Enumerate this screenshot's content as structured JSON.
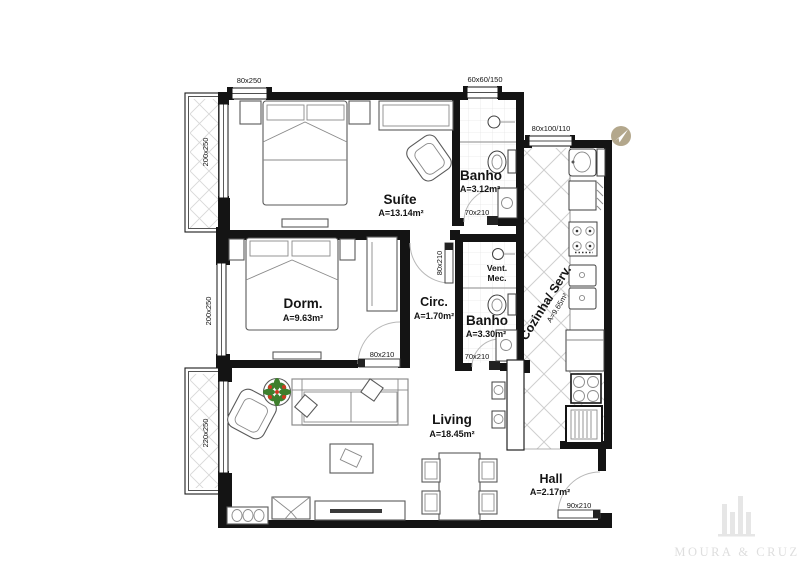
{
  "colors": {
    "background": "#ffffff",
    "walls": "#141414",
    "kitchen_hatch": "#cfcfcf",
    "balcony_hatch": "#d8d8d8",
    "bath_tile": "#e6e6e6",
    "north_icon": "#b3a78c",
    "plant_green": "#3e7f2d",
    "plant_red": "#cc3b22",
    "watermark": "#dedede"
  },
  "rooms": {
    "suite": {
      "name": "Suíte",
      "area": "A=13.14m²"
    },
    "dorm": {
      "name": "Dorm.",
      "area": "A=9.63m²"
    },
    "circ": {
      "name": "Circ.",
      "area": "A=1.70m²"
    },
    "banho_suite": {
      "name": "Banho",
      "area": "A=3.12m²"
    },
    "banho_social": {
      "name": "Banho",
      "area": "A=3.30m²"
    },
    "cozinha": {
      "name": "Cozinha/ Serv.",
      "area": "A=9.65m²"
    },
    "living": {
      "name": "Living",
      "area": "A=18.45m²"
    },
    "hall": {
      "name": "Hall",
      "area": "A=2.17m²"
    }
  },
  "annotations": {
    "vent_line1": "Vent.",
    "vent_line2": "Mec."
  },
  "dims": {
    "suite_window": "80x250",
    "bath_suite_window": "60x60/150",
    "kitchen_window": "80x100/110",
    "suite_balcony_door": "200x250",
    "dorm_window": "200x250",
    "living_balcony_door": "220x250",
    "bath_suite_door": "70x210",
    "bath_social_door": "70x210",
    "suite_door": "80x210",
    "dorm_door": "80x210",
    "entry_door": "90x210"
  },
  "watermark": {
    "name": "MOURA & CRUZ"
  },
  "icons": {
    "north": "north-arrow-icon",
    "plant": "plant-icon"
  }
}
